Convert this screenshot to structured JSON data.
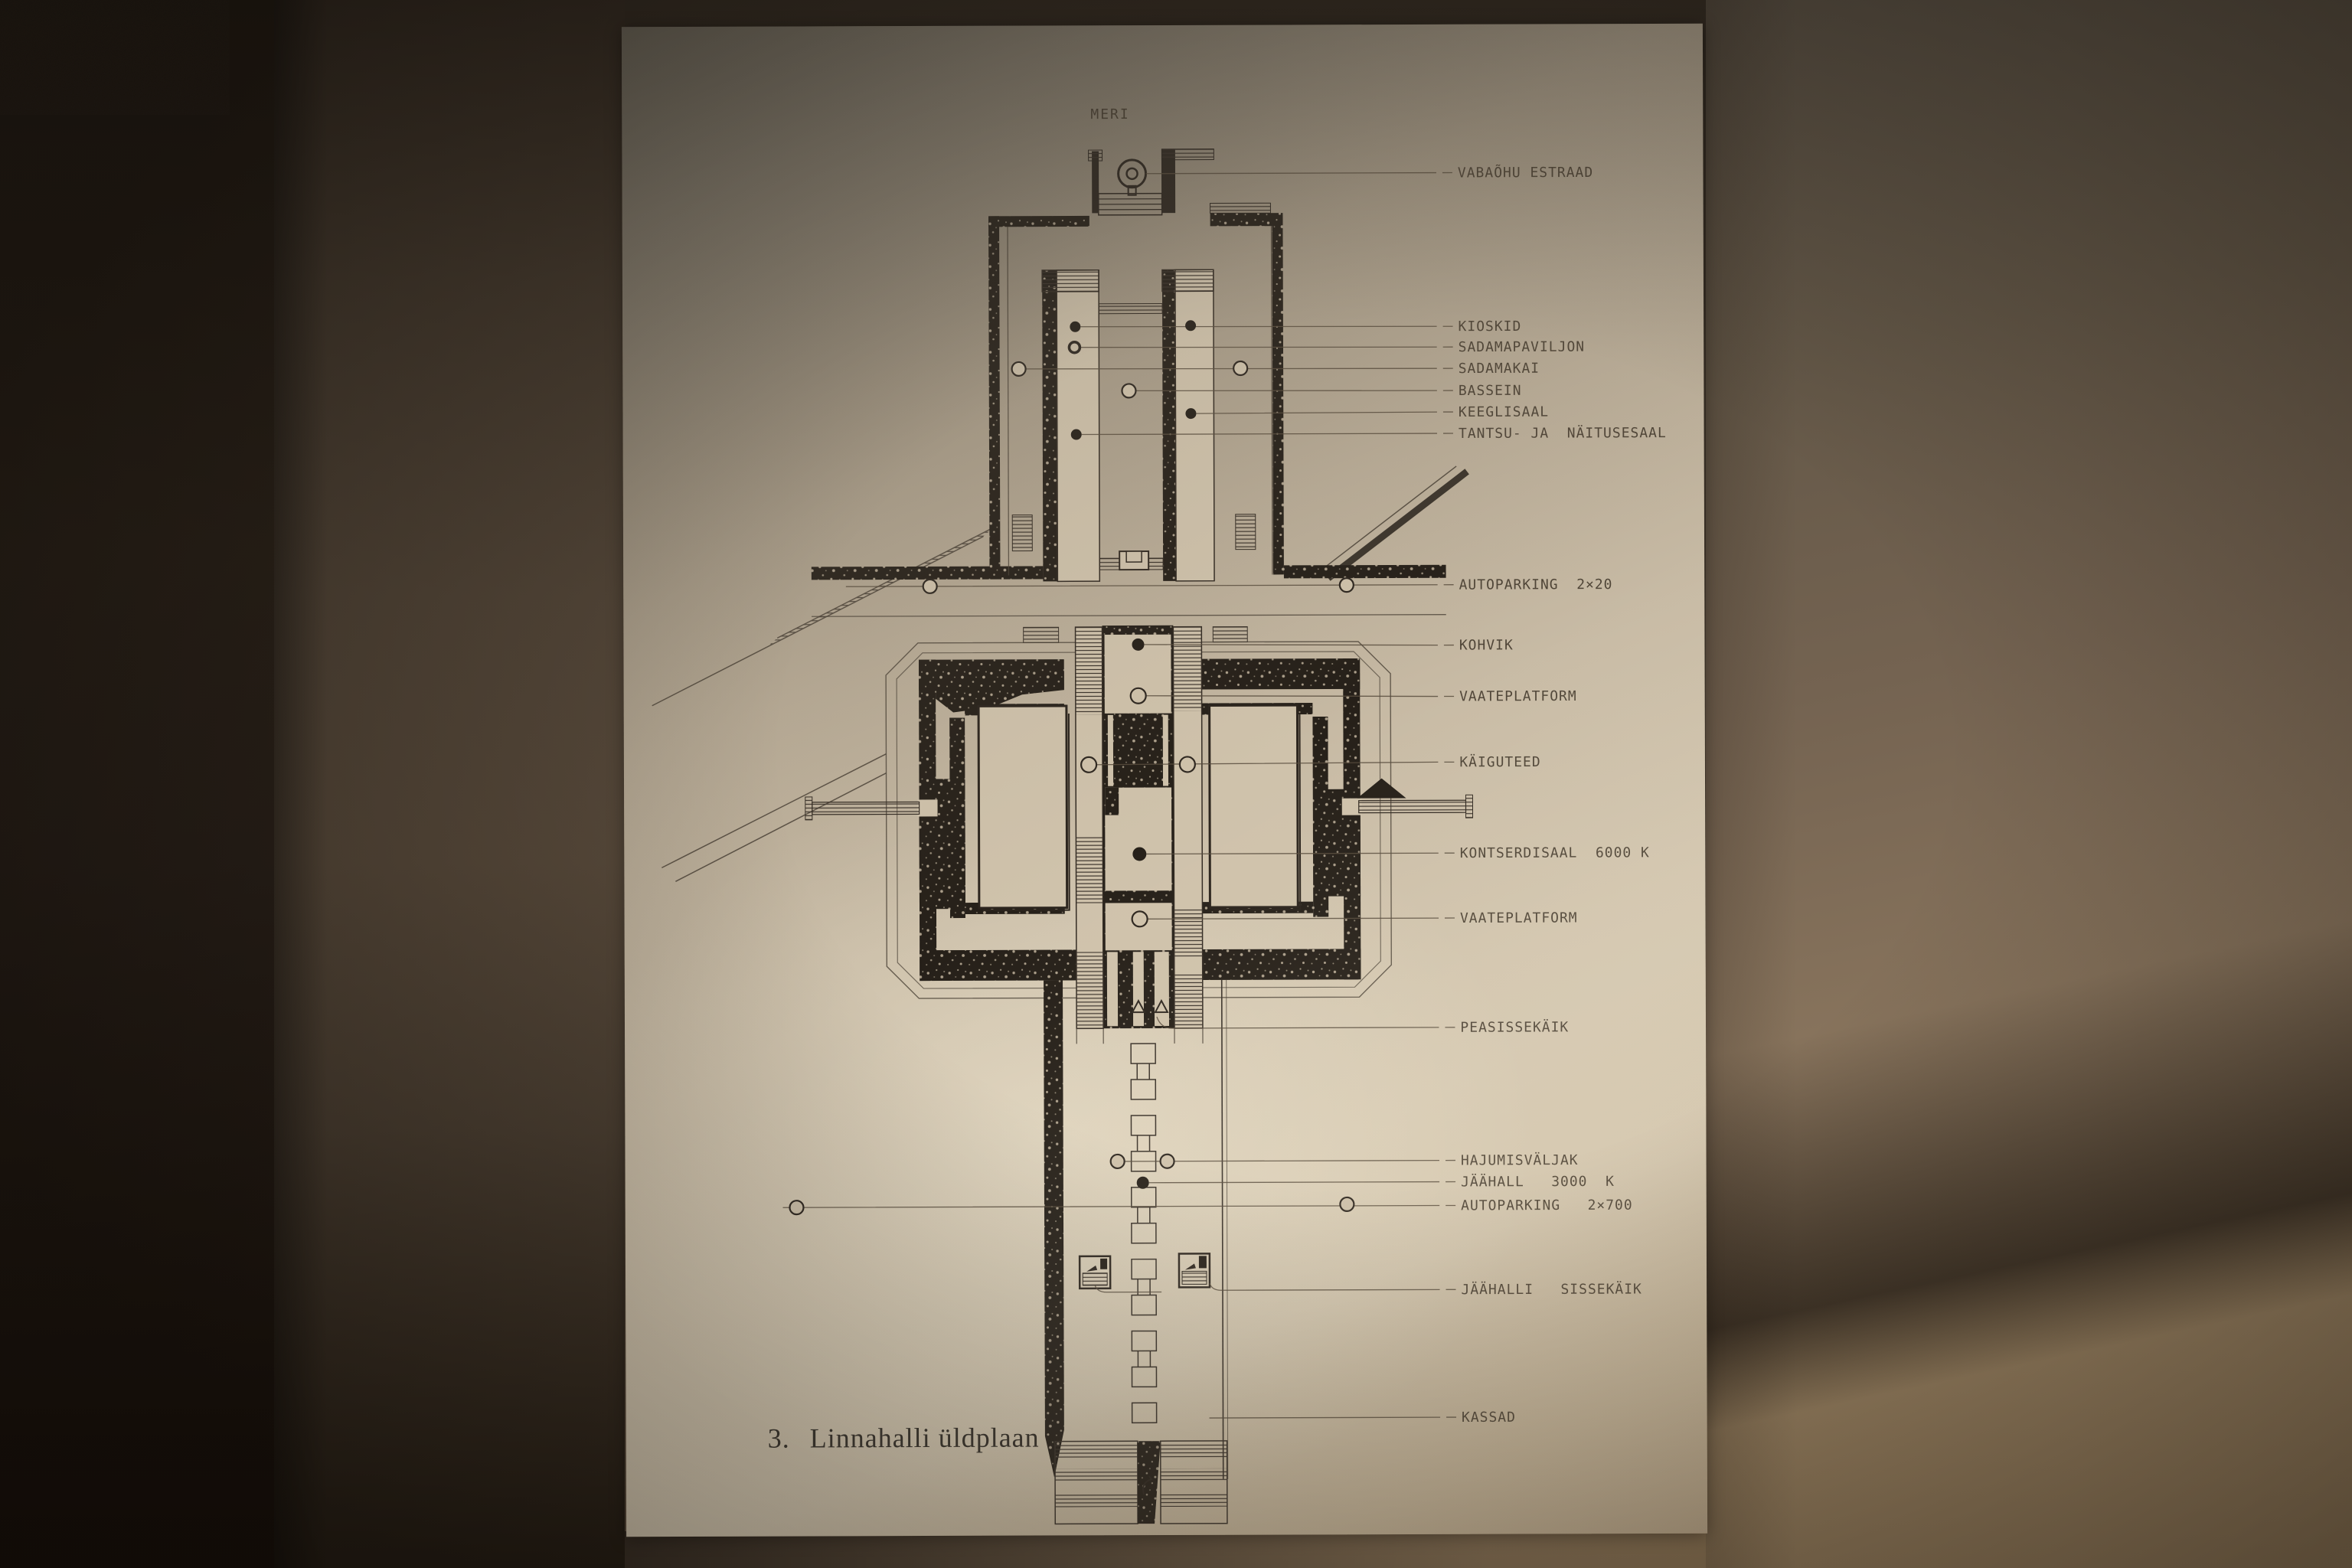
{
  "sea_label": "MERI",
  "caption": {
    "number": "3.",
    "title": "Linnahalli üldplaan"
  },
  "callouts": [
    {
      "text": "VABAÕHU ESTRAAD"
    },
    {
      "text": "KIOSKID"
    },
    {
      "text": "SADAMAPAVILJON"
    },
    {
      "text": "SADAMAKAI"
    },
    {
      "text": "BASSEIN"
    },
    {
      "text": "KEEGLISAAL"
    },
    {
      "text": "TANTSU- JA  NÄITUSESAAL"
    },
    {
      "text": "AUTOPARKING  2×20"
    },
    {
      "text": "KOHVIK"
    },
    {
      "text": "VAATEPLATFORM"
    },
    {
      "text": "KÄIGUTEED"
    },
    {
      "text": "KONTSERDISAAL  6000 K"
    },
    {
      "text": "VAATEPLATFORM"
    },
    {
      "text": "PEASISSEKÄIK"
    },
    {
      "text": "HAJUMISVÄLJAK"
    },
    {
      "text": "JÄÄHALL   3000  K"
    },
    {
      "text": "AUTOPARKING   2×700"
    },
    {
      "text": "JÄÄHALLI   SISSEKÄIK"
    },
    {
      "text": "KASSAD"
    }
  ],
  "colors": {
    "paper": "#cfc2ab",
    "ink": "#2e2720",
    "wall_left": "#3f362c",
    "wall_right": "#8c7860",
    "wall_dark": "#1f1811"
  }
}
